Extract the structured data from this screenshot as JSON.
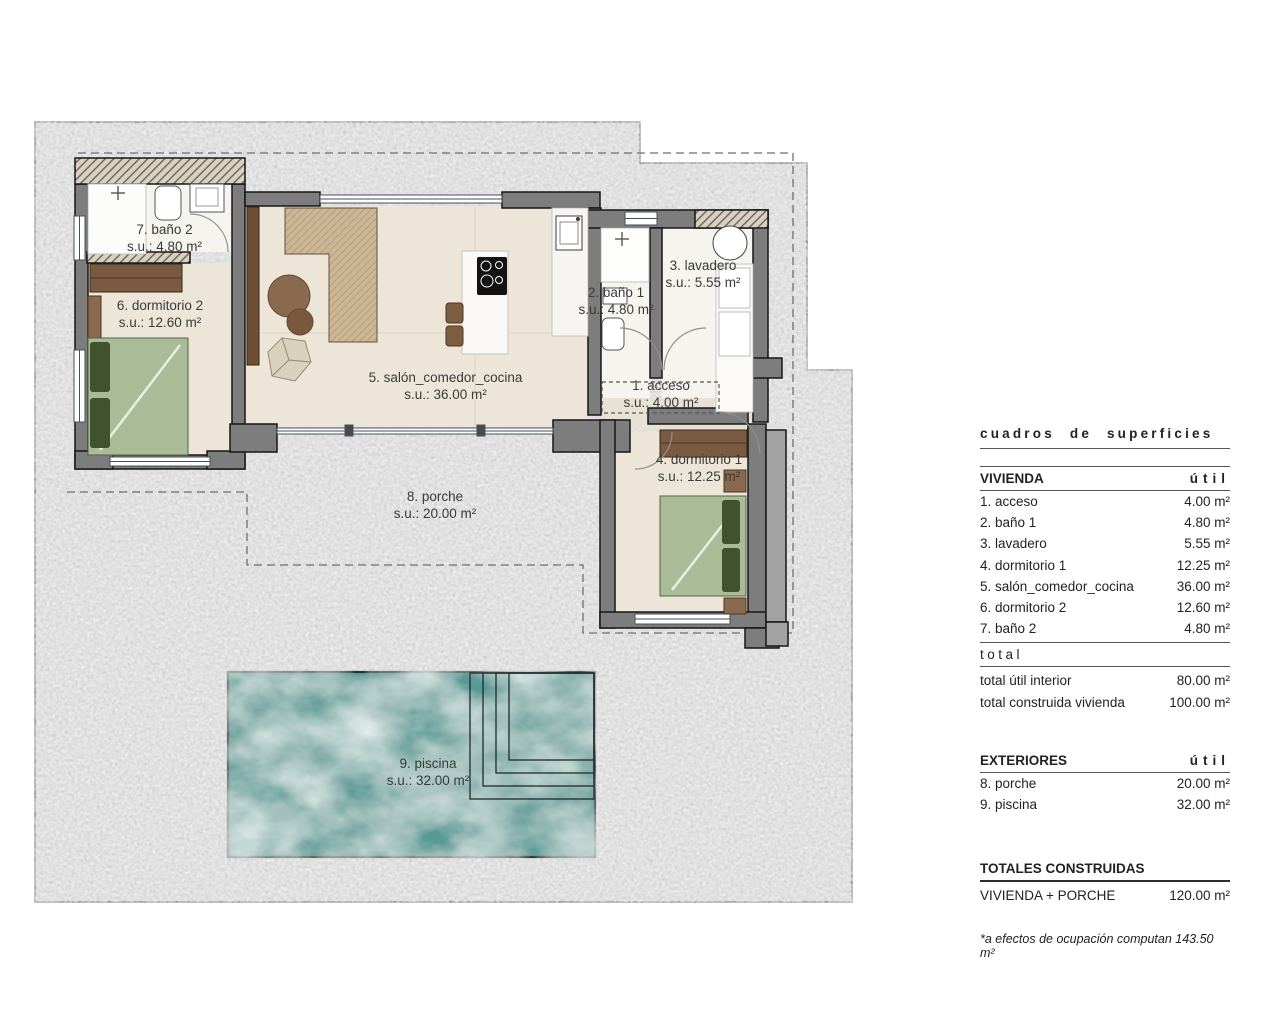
{
  "plan": {
    "rooms": [
      {
        "id": "acceso",
        "name": "1. acceso",
        "area": "s.u.: 4.00 m²"
      },
      {
        "id": "bano1",
        "name": "2. baño 1",
        "area": "s.u.: 4.80 m²"
      },
      {
        "id": "lavadero",
        "name": "3. lavadero",
        "area": "s.u.: 5.55 m²"
      },
      {
        "id": "dormitorio1",
        "name": "4. dormitorio 1",
        "area": "s.u.: 12.25 m²"
      },
      {
        "id": "salon",
        "name": "5. salón_comedor_cocina",
        "area": "s.u.: 36.00 m²"
      },
      {
        "id": "dormitorio2",
        "name": "6. dormitorio 2",
        "area": "s.u.: 12.60 m²"
      },
      {
        "id": "bano2",
        "name": "7. baño 2",
        "area": "s.u.: 4.80 m²"
      },
      {
        "id": "porche",
        "name": "8. porche",
        "area": "s.u.: 20.00 m²"
      },
      {
        "id": "piscina",
        "name": "9. piscina",
        "area": "s.u.: 32.00 m²"
      }
    ]
  },
  "table": {
    "title": "cuadros de superficies",
    "vivienda": {
      "header": "VIVIENDA",
      "unit": "útil",
      "rows": [
        {
          "label": "1. acceso",
          "value": "4.00 m²"
        },
        {
          "label": "2. baño 1",
          "value": "4.80 m²"
        },
        {
          "label": "3. lavadero",
          "value": "5.55 m²"
        },
        {
          "label": "4. dormitorio 1",
          "value": "12.25 m²"
        },
        {
          "label": "5. salón_comedor_cocina",
          "value": "36.00 m²"
        },
        {
          "label": "6. dormitorio 2",
          "value": "12.60 m²"
        },
        {
          "label": "7. baño 2",
          "value": "4.80 m²"
        }
      ],
      "total_label": "total",
      "totals": [
        {
          "label": "total útil interior",
          "value": "80.00 m²"
        },
        {
          "label": "total construida vivienda",
          "value": "100.00 m²"
        }
      ]
    },
    "exteriores": {
      "header": "EXTERIORES",
      "unit": "útil",
      "rows": [
        {
          "label": "8. porche",
          "value": "20.00 m²"
        },
        {
          "label": "9. piscina",
          "value": "32.00 m²"
        }
      ]
    },
    "totales": {
      "header": "TOTALES CONSTRUIDAS",
      "rows": [
        {
          "label": "VIVIENDA + PORCHE",
          "value": "120.00 m²"
        }
      ]
    },
    "footnote": "*a efectos de ocupación computan 143.50 m²"
  },
  "colors": {
    "terrain": "#c7c7c7",
    "wall": "#7d7d7d",
    "wall_outline": "#161616",
    "pool_water": "#579a95",
    "floor_beige": "#ece5d8",
    "floor_white": "#f6f4ef",
    "wood": "#7a5b41",
    "bed_green": "#aabc97",
    "pillow_green": "#41522f"
  }
}
